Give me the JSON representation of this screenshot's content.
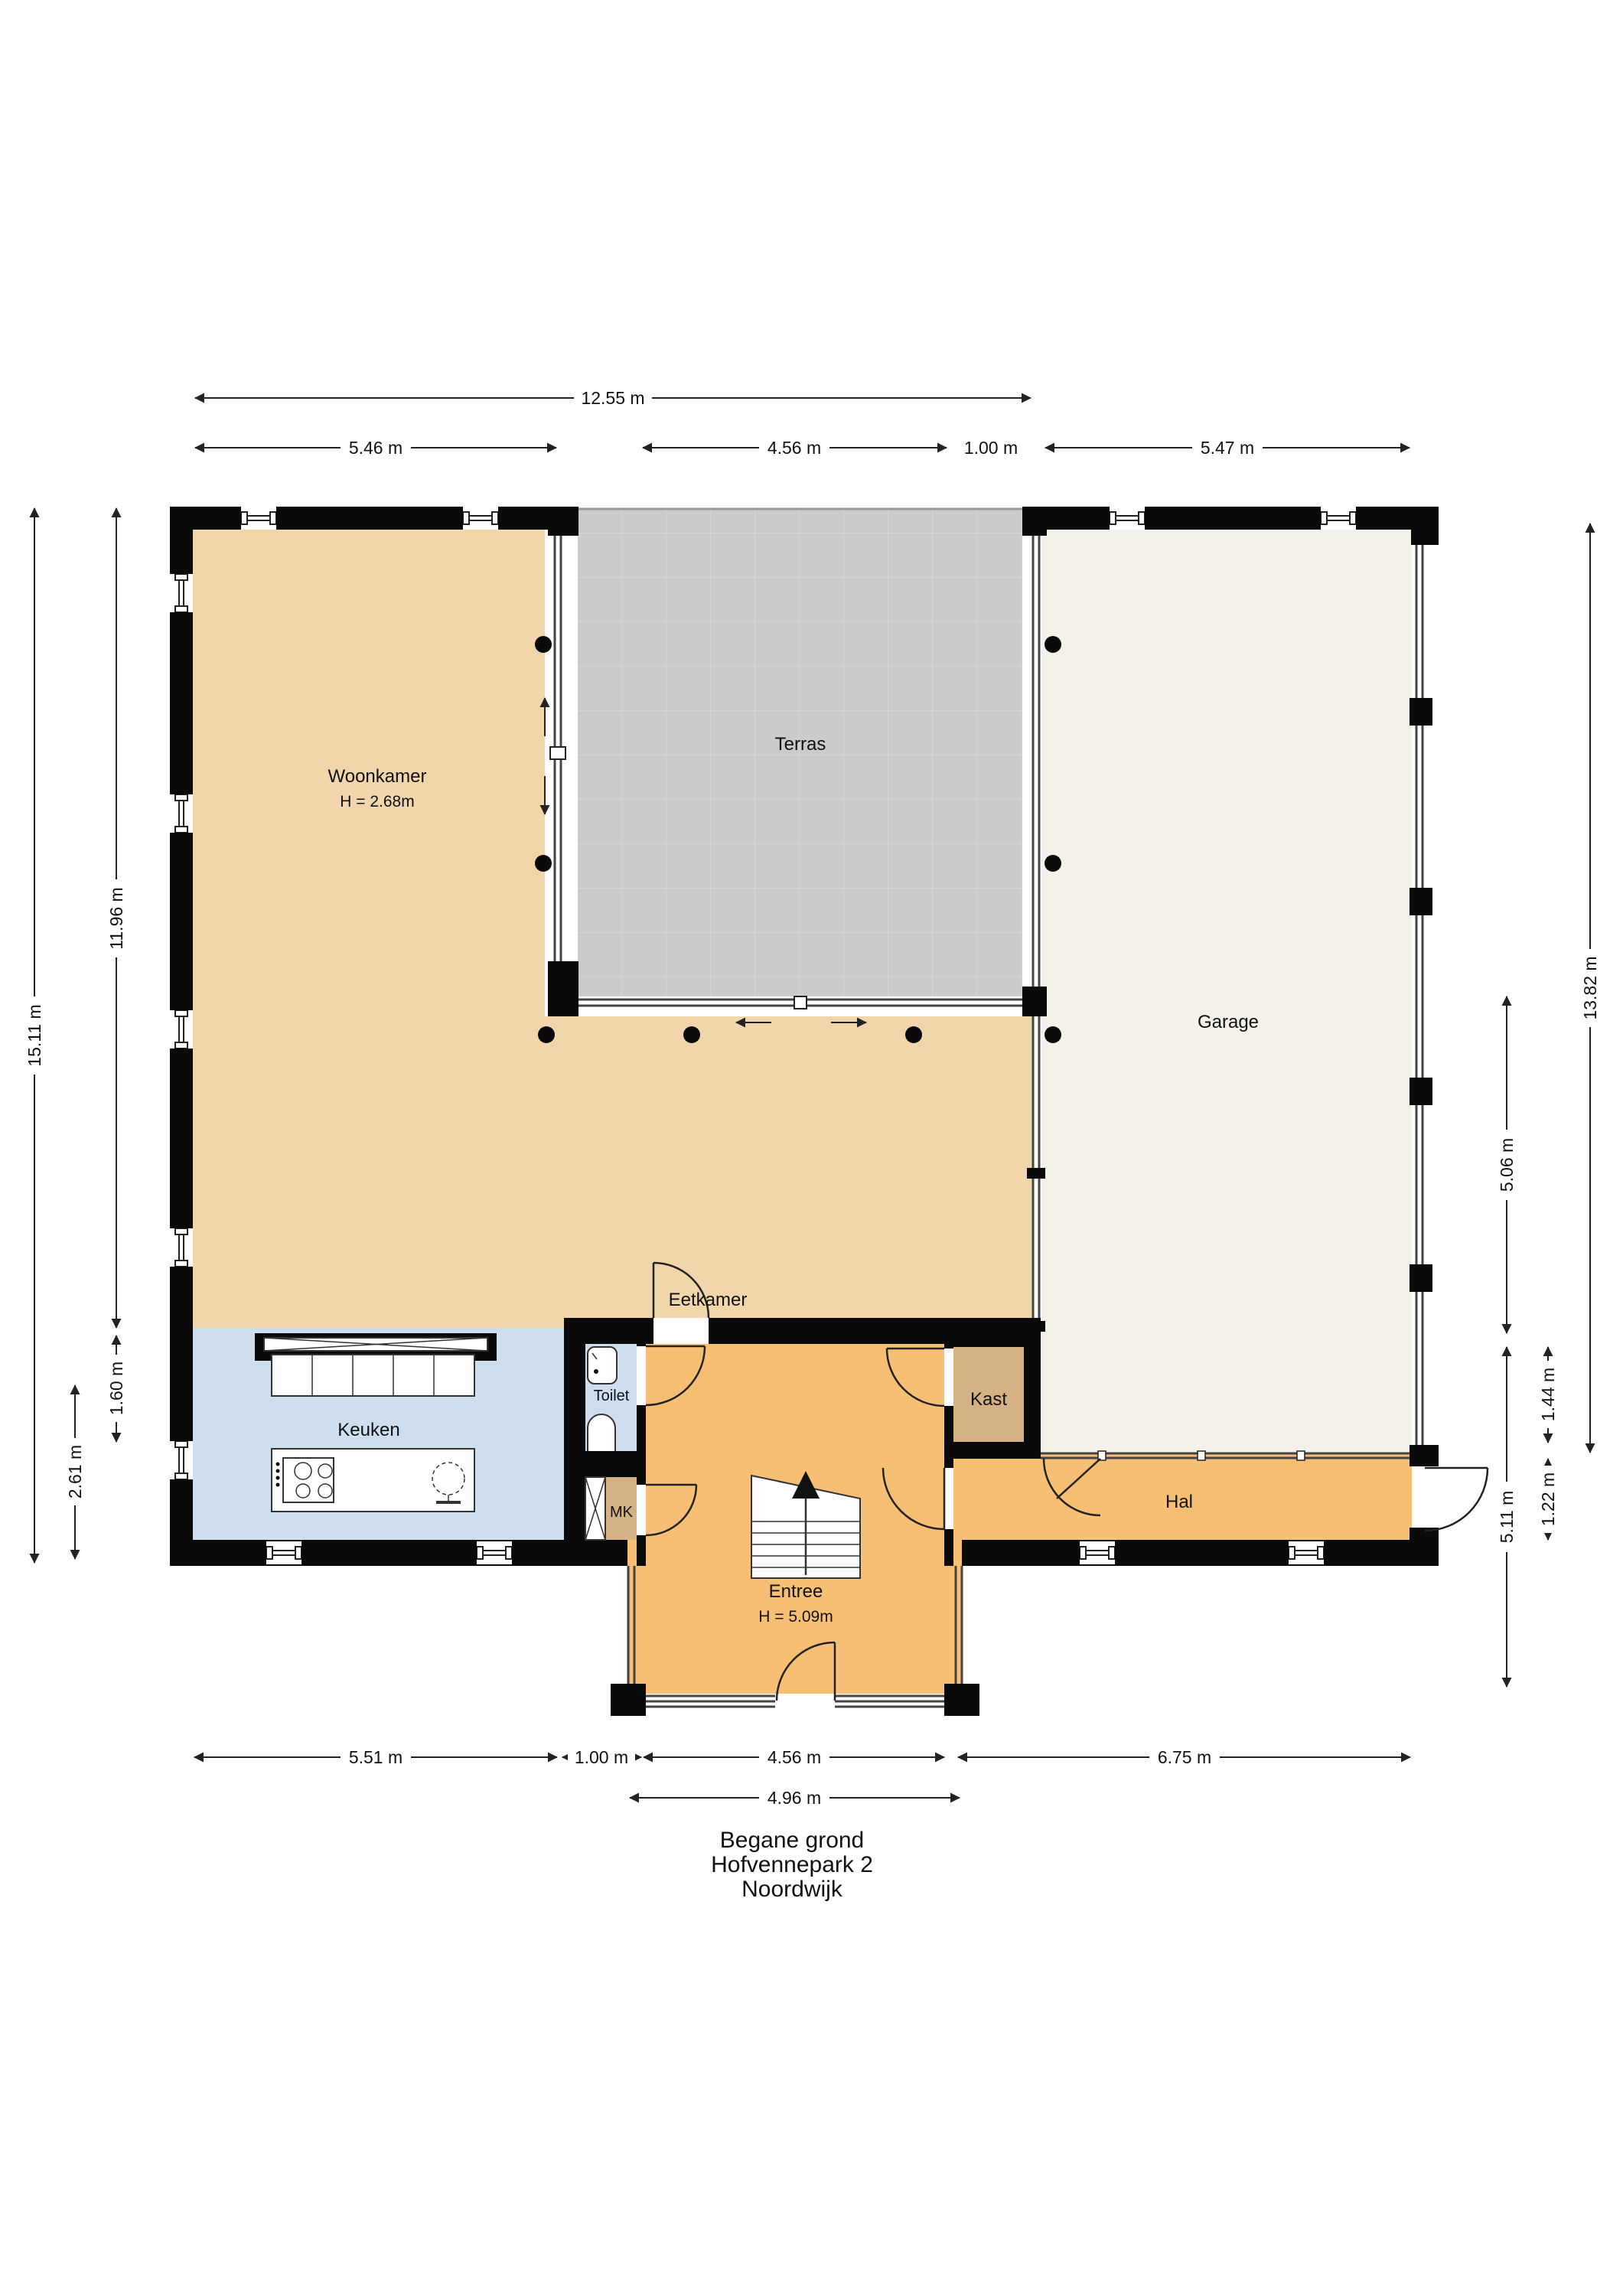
{
  "title": {
    "line1": "Begane grond",
    "line2": "Hofvennepark 2",
    "line3": "Noordwijk"
  },
  "rooms": {
    "woonkamer": {
      "label": "Woonkamer",
      "height_label": "H = 2.68m"
    },
    "terras": {
      "label": "Terras"
    },
    "garage": {
      "label": "Garage"
    },
    "eetkamer": {
      "label": "Eetkamer"
    },
    "keuken": {
      "label": "Keuken"
    },
    "toilet": {
      "label": "Toilet"
    },
    "mk": {
      "label": "MK"
    },
    "kast": {
      "label": "Kast"
    },
    "hal": {
      "label": "Hal"
    },
    "entree": {
      "label": "Entree",
      "height_label": "H = 5.09m"
    }
  },
  "dimensions": {
    "top": [
      {
        "label": "12.55 m"
      },
      {
        "label": "5.46 m"
      },
      {
        "label": "4.56 m"
      },
      {
        "label": "1.00 m"
      },
      {
        "label": "5.47 m"
      }
    ],
    "bottom": [
      {
        "label": "5.51 m"
      },
      {
        "label": "1.00 m"
      },
      {
        "label": "4.56 m"
      },
      {
        "label": "6.75 m"
      },
      {
        "label": "4.96 m"
      }
    ],
    "left": [
      {
        "label": "15.11 m"
      },
      {
        "label": "11.96 m"
      },
      {
        "label": "1.60 m"
      },
      {
        "label": "2.61 m"
      }
    ],
    "right": [
      {
        "label": "13.82 m"
      },
      {
        "label": "5.06 m"
      },
      {
        "label": "1.44 m"
      },
      {
        "label": "1.22 m"
      },
      {
        "label": "5.11 m"
      }
    ]
  },
  "colors": {
    "living_fill": "#f0d6aa",
    "kitchen_fill": "#cfdeee",
    "hall_fill": "#f6bf73",
    "closet_fill": "#d5b285",
    "terrace_fill": "#cbcbcb",
    "garage_fill": "#f4f2e8",
    "wall": "#0a0a0a"
  }
}
